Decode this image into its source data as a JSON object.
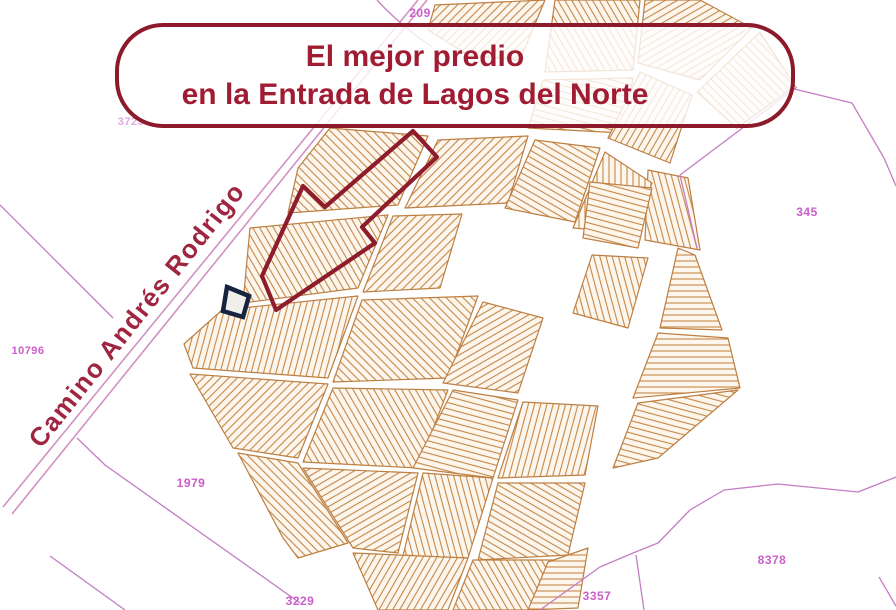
{
  "banner": {
    "line1": "El mejor predio",
    "line2": "en la Entrada de Lagos del Norte"
  },
  "road_label": "Camino Andrés Rodrigo",
  "parcel_labels": [
    {
      "text": "209"
    },
    {
      "text": "3723"
    },
    {
      "text": "345"
    },
    {
      "text": "10796"
    },
    {
      "text": "1979"
    },
    {
      "text": "8378"
    },
    {
      "text": "3357"
    },
    {
      "text": "3229"
    }
  ],
  "highlight": {
    "name": "selected-parcel"
  },
  "colors": {
    "banner_border": "#8c1a2a",
    "banner_text": "#a01c33",
    "road_name_text": "#a02540",
    "callout_arrow": "#8d1c2c",
    "road_line": "#d191c2",
    "boundary_line": "#c47ec4",
    "parcel_line": "#c48748",
    "parcel_block_fill": "#fdf6ec",
    "label_magenta": "#cb5ecb",
    "highlight_outline": "#17243f",
    "background": "#ffffff"
  }
}
